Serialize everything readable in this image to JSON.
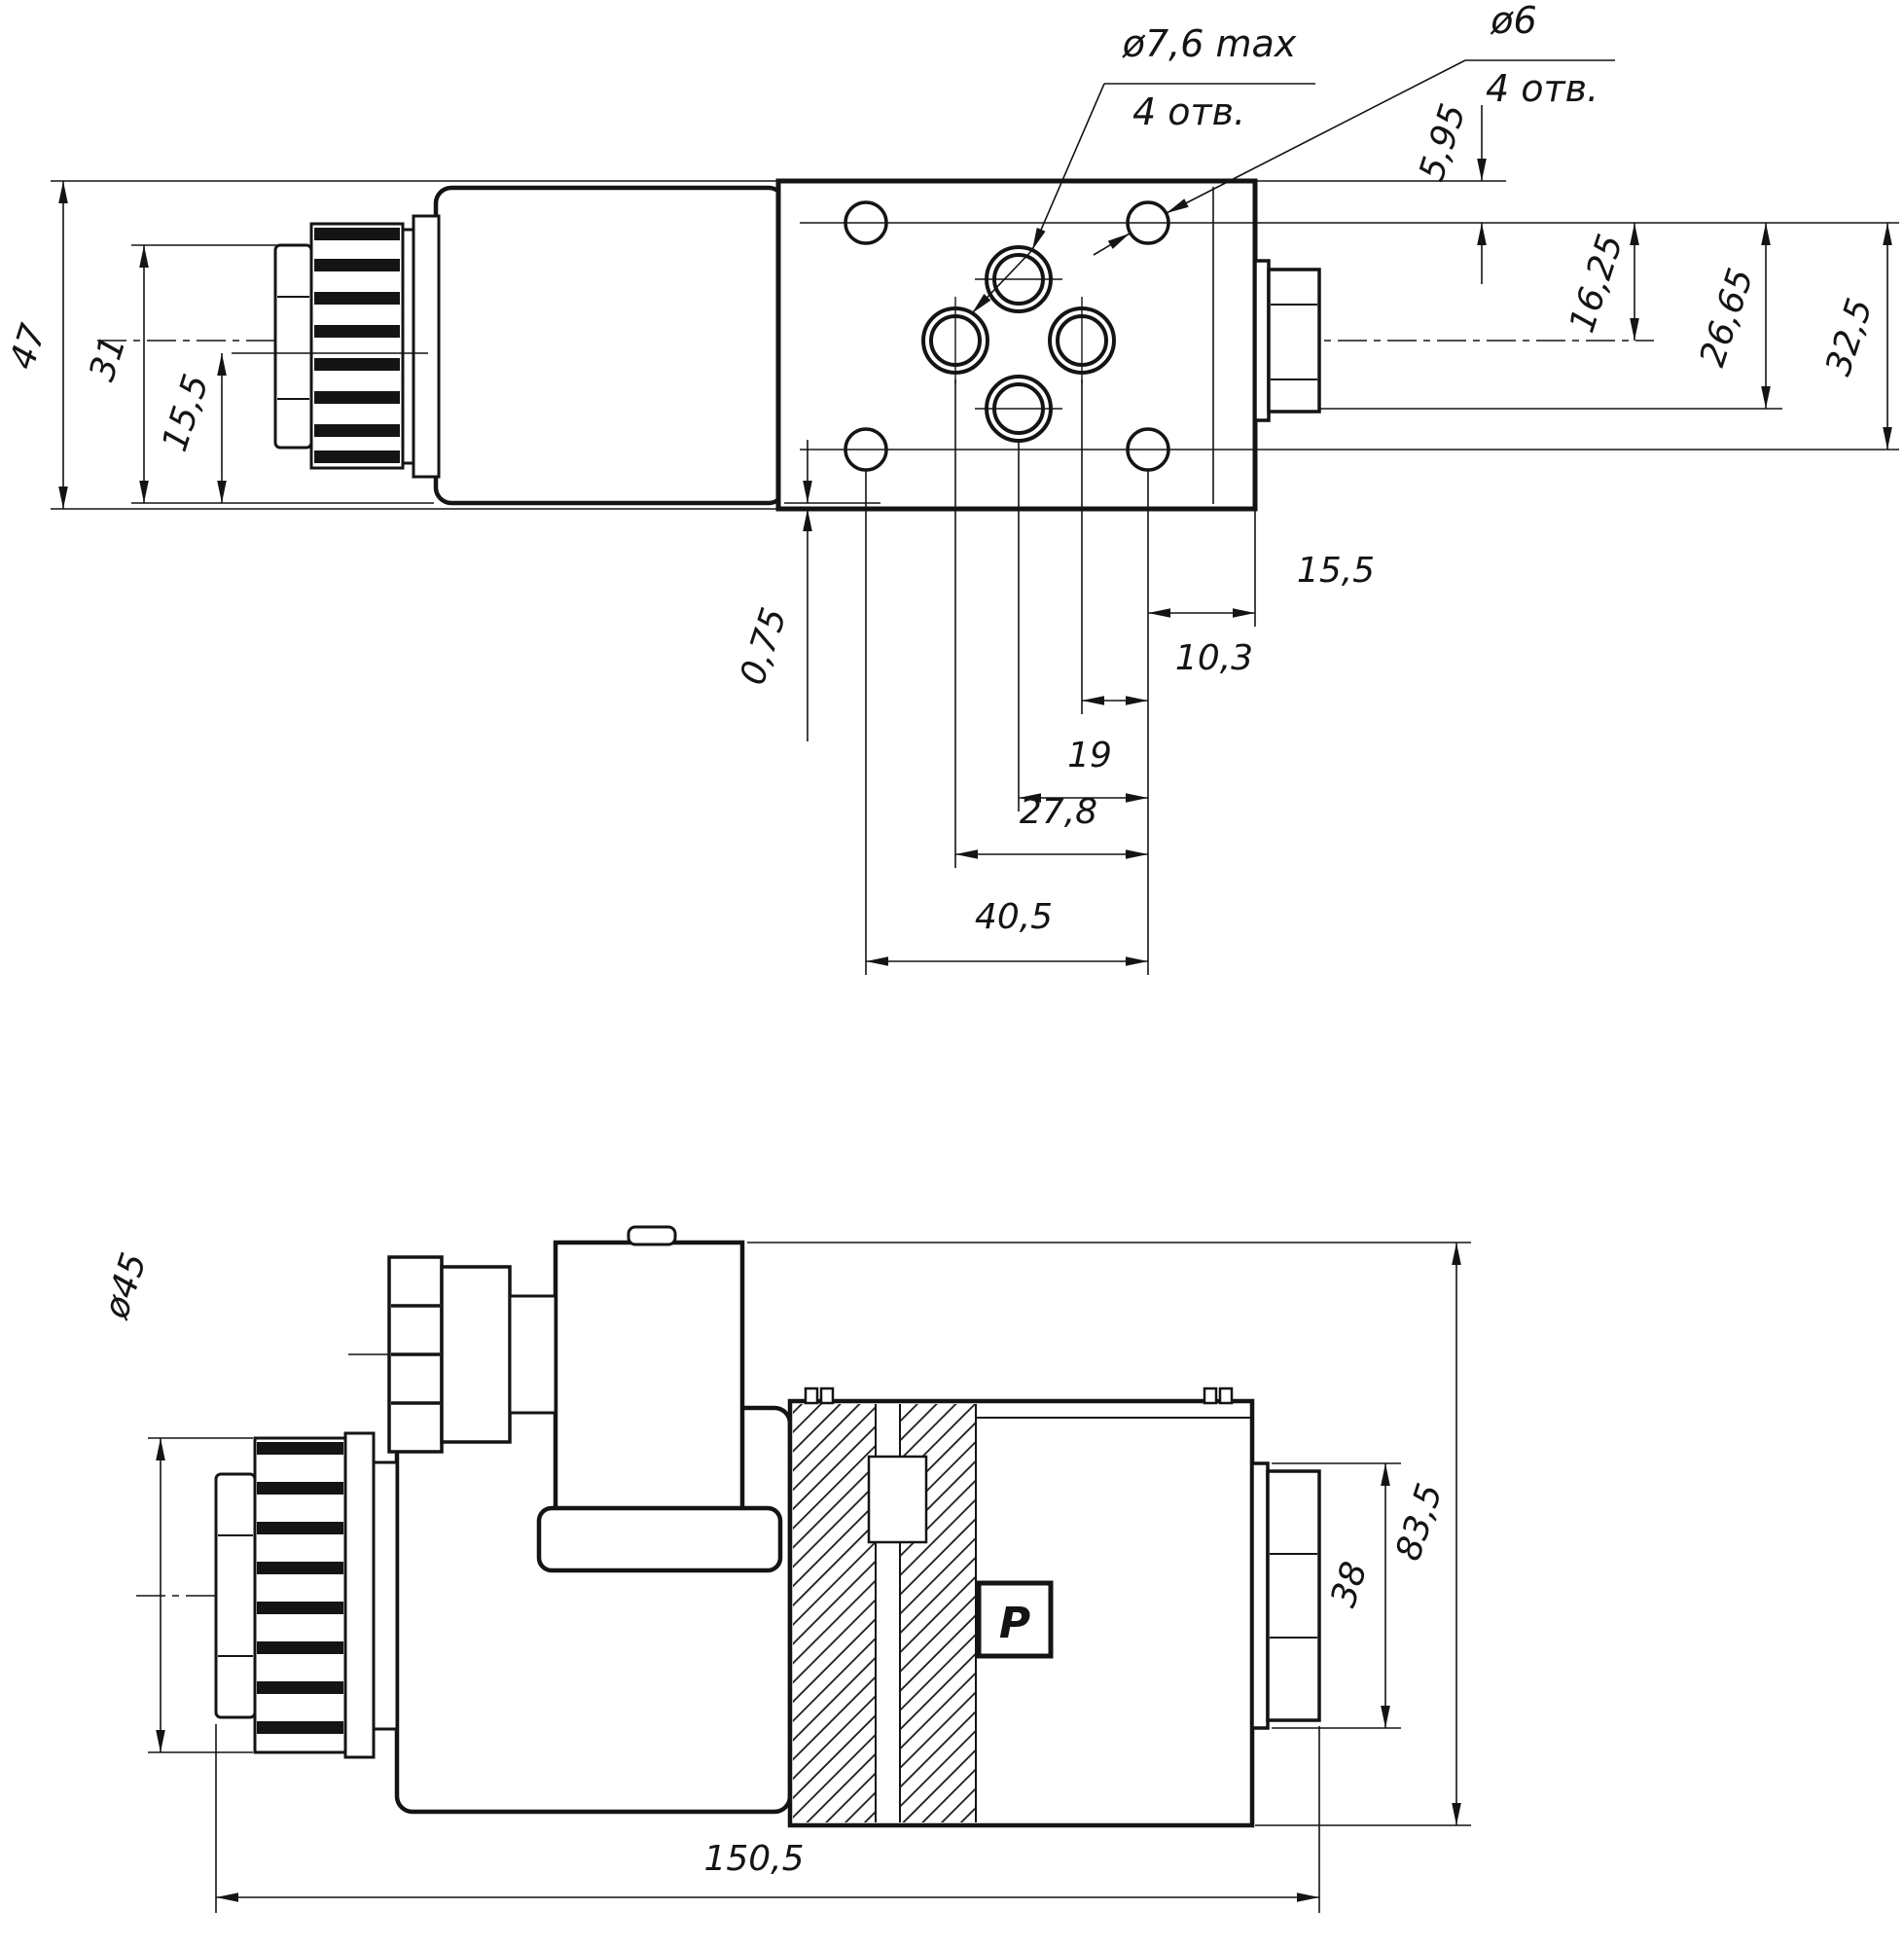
{
  "page": {
    "background": "#ffffff",
    "ink": "#141414"
  },
  "top_view": {
    "dims": {
      "overall_height": "47",
      "connector_height": "31",
      "connector_half_height": "15,5",
      "hole_row_offset": "5,95",
      "row_16_25": "16,25",
      "row_26_65": "26,65",
      "row_32_5": "32,5",
      "edge_to_hole": "15,5",
      "hole_to_port": "10,3",
      "port_span": "19",
      "span_27_8": "27,8",
      "span_40_5": "40,5",
      "edge_step": "0,75"
    },
    "leaders": {
      "port_dia": "ø7,6 max",
      "port_qty": "4 отв.",
      "mount_dia": "ø6",
      "mount_qty": "4 отв."
    }
  },
  "side_view": {
    "dims": {
      "connector_dia": "ø45",
      "overall_height": "83,5",
      "fitting_height": "38",
      "overall_length": "150,5"
    },
    "port_mark": "P"
  }
}
